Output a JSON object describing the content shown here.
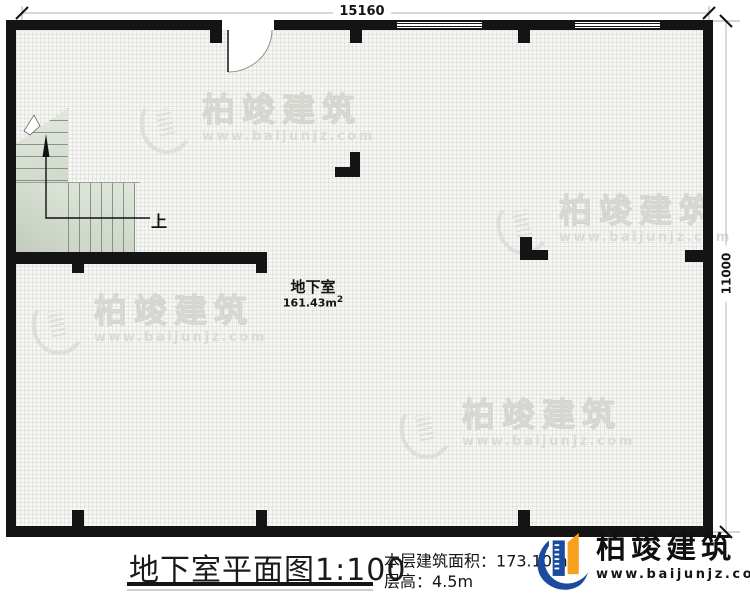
{
  "plan": {
    "dim_top": "15160",
    "dim_right": "11000",
    "room": {
      "name": "地下室",
      "area_value": "161.43m",
      "area_sup": "2"
    },
    "stair_up_label": "上"
  },
  "footer": {
    "title": "地下室平面图",
    "scale": "1:100",
    "area_label": "本层建筑面积：",
    "area_value": "173.10m",
    "area_sup": "2",
    "height_label": "层高：",
    "height_value": "4.5m"
  },
  "brand": {
    "name": "柏竣建筑",
    "url": "www.baijunjz.com"
  },
  "watermark": {
    "name": "柏竣建筑",
    "url": "www.baijunjz.com"
  },
  "colors": {
    "wall": "#141414",
    "brand_blue": "#1b4b9e",
    "brand_orange": "#f7a01e",
    "stair_fill": "#dfe5da",
    "watermark_gray": "#dededa"
  }
}
